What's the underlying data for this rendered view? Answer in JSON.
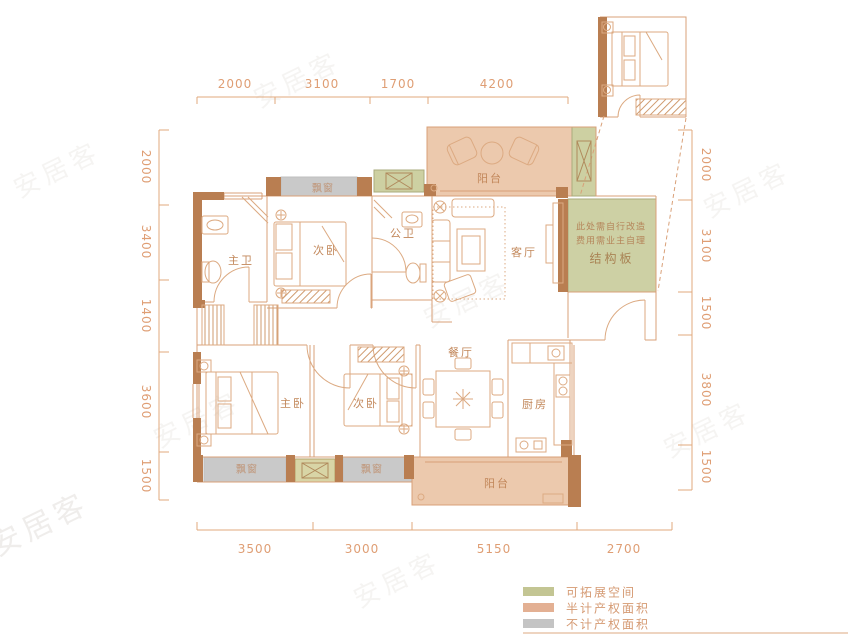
{
  "colors": {
    "wall": "#b97e51",
    "line": "#d9a078",
    "dim_text": "#df9e74",
    "label_text": "#c2875a",
    "fill_half_area": "#ecc9ad",
    "fill_expandable": "#cdd0a2",
    "fill_excluded": "#c9c9c9"
  },
  "rooms": {
    "bath_master": "主卫",
    "bedroom_top": "次卧",
    "bath_public": "公卫",
    "living": "客厅",
    "dining": "餐厅",
    "kitchen": "厨房",
    "bedroom_master": "主卧",
    "bedroom_bottom": "次卧",
    "balcony_top": "阳台",
    "balcony_bottom": "阳台",
    "bay_top": "飘窗",
    "bay_bottom_left": "飘窗",
    "bay_bottom_right": "飘窗"
  },
  "note": {
    "line1": "此处需自行改造",
    "line2": "费用需业主自理",
    "line3": "结构板"
  },
  "dims": {
    "top": [
      "2000",
      "3100",
      "1700",
      "4200"
    ],
    "left": [
      "2000",
      "3400",
      "1400",
      "3600",
      "1500"
    ],
    "right": [
      "2000",
      "3100",
      "1500",
      "3800",
      "1500"
    ],
    "bottom": [
      "3500",
      "3000",
      "5150",
      "2700"
    ]
  },
  "legend": {
    "items": [
      {
        "label": "可拓展空间",
        "color": "#c3c593"
      },
      {
        "label": "半计产权面积",
        "color": "#e3b093"
      },
      {
        "label": "不计产权面积",
        "color": "#c4c4c4"
      }
    ]
  },
  "watermark": {
    "text": "安居客"
  }
}
